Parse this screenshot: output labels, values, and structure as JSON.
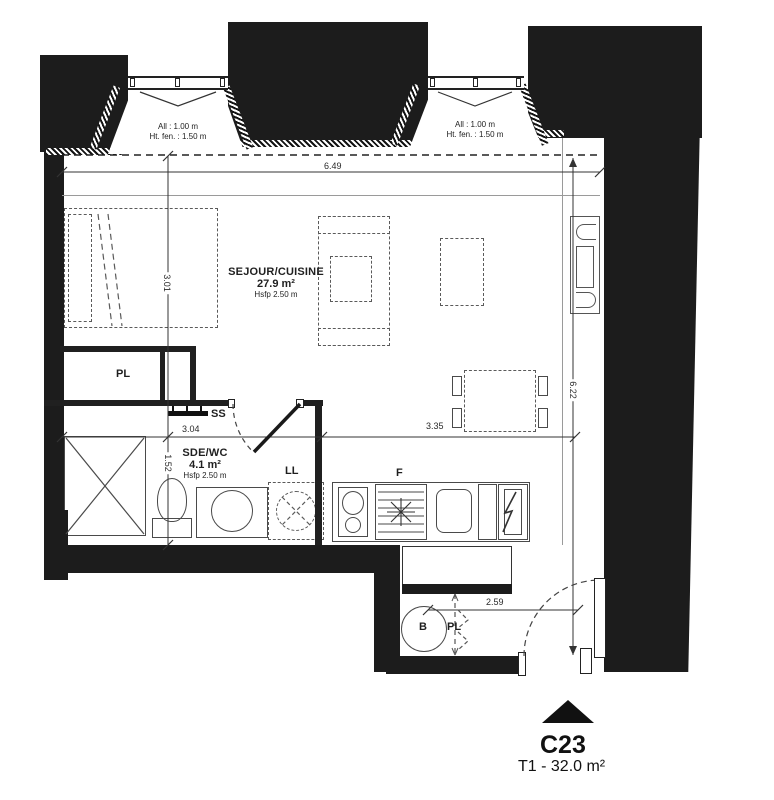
{
  "title_block": {
    "unit": "C23",
    "type_area": "T1 - 32.0 m²"
  },
  "windows": [
    {
      "allege": "All : 1.00 m",
      "hauteur": "Ht. fen. : 1.50 m"
    },
    {
      "allege": "All : 1.00 m",
      "hauteur": "Ht. fen. : 1.50 m"
    }
  ],
  "rooms": [
    {
      "name": "SEJOUR/CUISINE",
      "area": "27.9 m²",
      "height": "Hsfp 2.50 m"
    },
    {
      "name": "SDE/WC",
      "area": "4.1 m²",
      "height": "Hsfp 2.50 m"
    }
  ],
  "labels": {
    "closet": "PL",
    "towel_dryer": "SS",
    "washer": "LL",
    "fridge": "F",
    "water_heater": "B",
    "entry_closet": "PL"
  },
  "dimensions": {
    "top_width": "6.49",
    "living_height": "3.01",
    "bath_height": "1.52",
    "bath_width": "3.04",
    "kitchen_width": "3.35",
    "right_height": "6.22",
    "entry_width": "2.59"
  },
  "colors": {
    "wall": "#1c1c1c",
    "line": "#2e2e2e"
  }
}
